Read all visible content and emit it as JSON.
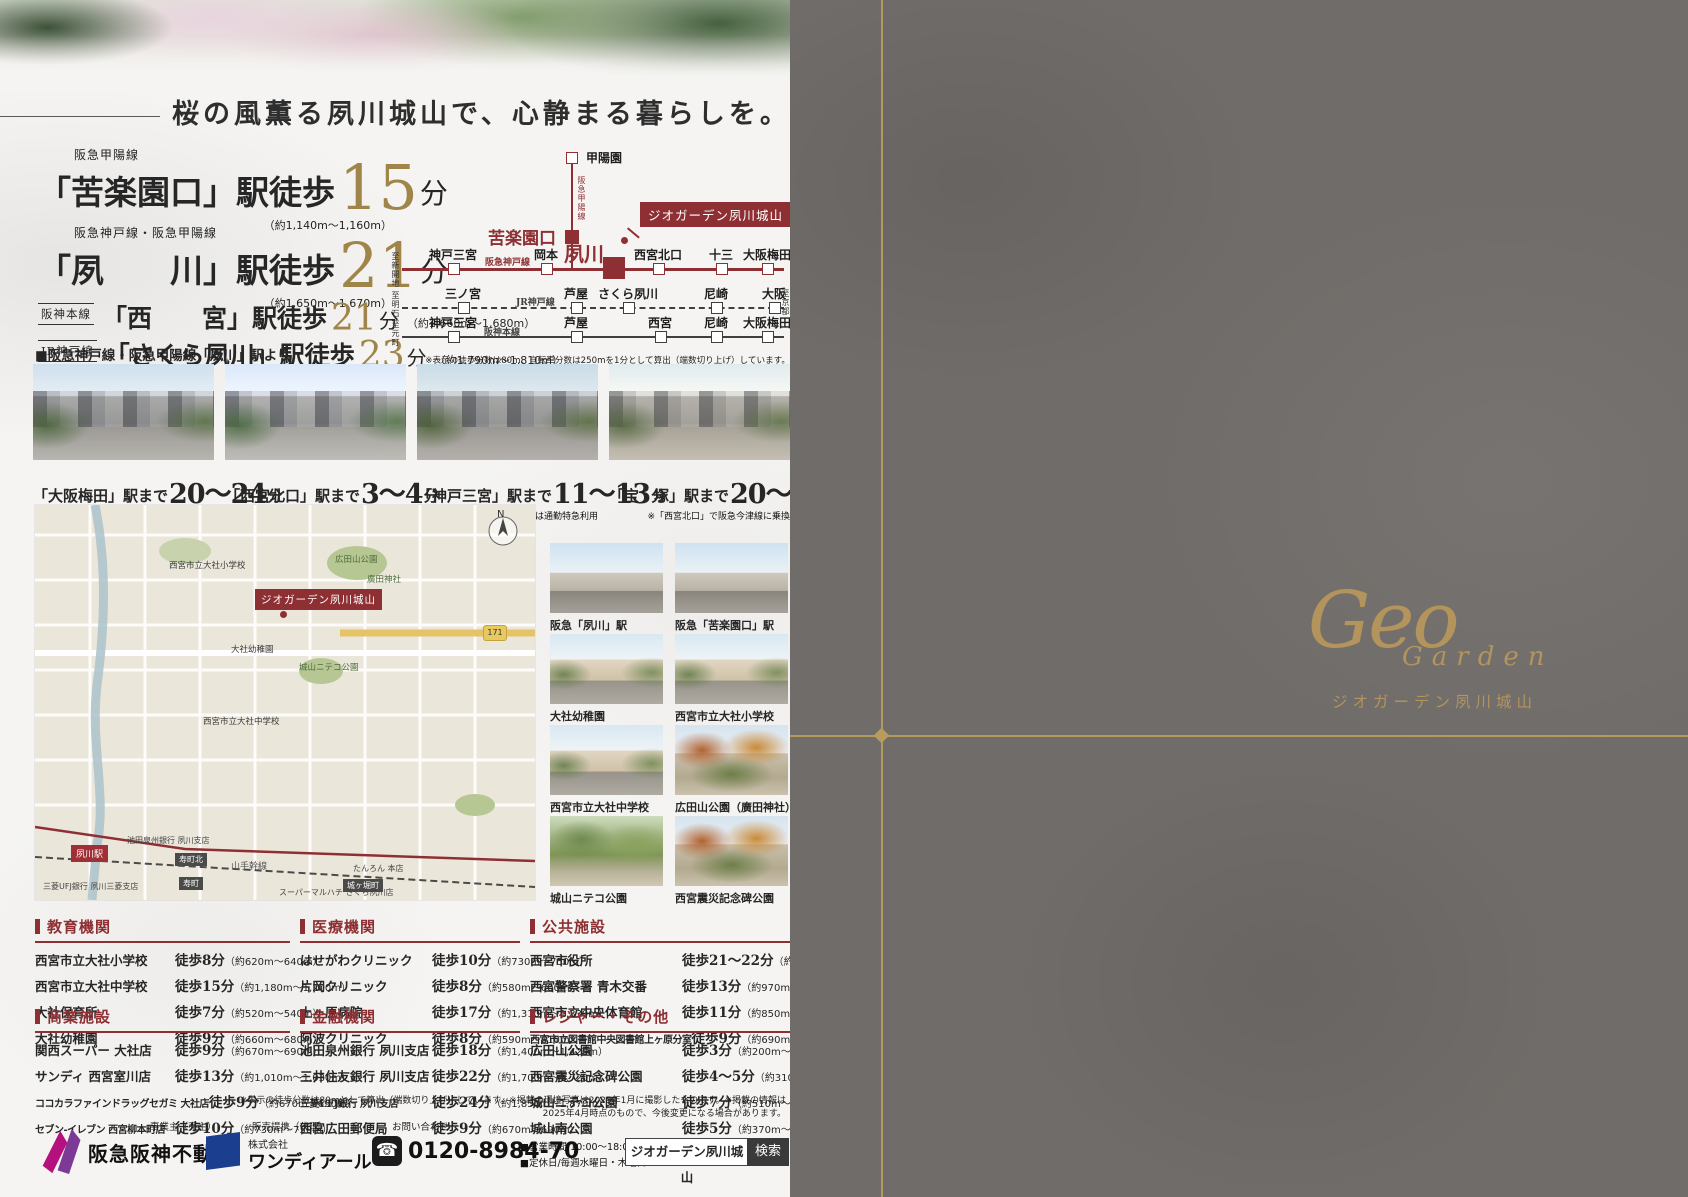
{
  "headline": {
    "text": "桜の風薫る夙川城山で、心静まる暮らしを。"
  },
  "access": {
    "stations": [
      {
        "line": "阪急甲陽線",
        "boxed": false,
        "station": "「苦楽園口」駅徒歩",
        "minutes": "15",
        "unit": "分",
        "distance": "（約1,140m〜1,160m）",
        "size": "l"
      },
      {
        "line": "阪急神戸線・阪急甲陽線",
        "boxed": false,
        "station": "「夙　　川」駅徒歩",
        "minutes": "21",
        "unit": "分",
        "distance": "（約1,650m〜1,670m）",
        "size": "l"
      },
      {
        "line": "阪神本線",
        "boxed": true,
        "station": "「西　　宮」駅徒歩",
        "minutes": "21",
        "unit": "分",
        "distance": "（約1,660m〜1,680m）",
        "size": "s"
      },
      {
        "line": "JR神戸線",
        "boxed": true,
        "station": "「さくら夙川」駅徒歩",
        "minutes": "23",
        "unit": "分",
        "distance": "（約1,790m〜1,810m）",
        "size": "s"
      }
    ]
  },
  "diagram": {
    "branch_line": "阪急甲陽線",
    "branch_top": "甲陽園",
    "branch_mid": "苦楽園口",
    "hub": "夙川",
    "property_flag": "ジオガーデン夙川城山",
    "lines": [
      {
        "name": "阪急神戸線",
        "left_to": "至新開地",
        "right_to": "",
        "stations": [
          "神戸三宮",
          "岡本",
          "西宮北口",
          "十三",
          "大阪梅田"
        ]
      },
      {
        "name": "JR神戸線",
        "left_to": "至明石",
        "right_to": "至京都",
        "stations": [
          "三ノ宮",
          "芦屋",
          "さくら夙川",
          "尼崎",
          "大阪"
        ]
      },
      {
        "name": "阪神本線",
        "left_to": "至元町",
        "right_to": "",
        "stations": [
          "神戸三宮",
          "芦屋",
          "西宮",
          "尼崎",
          "大阪梅田"
        ]
      }
    ],
    "note": "※表示の徒歩分数は80m、自転車分数は250mを1分として算出（端数切り上げ）しています。"
  },
  "station_photos": {
    "section_label": "■阪急神戸線・阪急甲陽線「夙川」駅より",
    "items": [
      {
        "pre": "「大阪梅田」駅まで",
        "time": "20〜24",
        "unit": "分",
        "note": "※特急または通勤特急利用"
      },
      {
        "pre": "「西宮北口」駅まで",
        "time": "3〜4",
        "unit": "分",
        "note": ""
      },
      {
        "pre": "「神戸三宮」駅まで",
        "time": "11〜13",
        "unit": "分",
        "note": "※特急または通勤特急利用"
      },
      {
        "pre": "「宝　塚」駅まで",
        "time": "20〜26",
        "unit": "分",
        "note": "※「西宮北口」で阪急今津線に乗換"
      }
    ]
  },
  "map": {
    "compass": "N",
    "route_badge": "171",
    "labels": [
      {
        "text": "ジオガーデン夙川城山",
        "type": "flag",
        "x": 220,
        "y": 84
      },
      {
        "text": "夙川駅",
        "type": "stationbox",
        "x": 36,
        "y": 340
      },
      {
        "text": "寿町北",
        "type": "darkbox",
        "x": 140,
        "y": 348
      },
      {
        "text": "寿町",
        "type": "darkbox",
        "x": 144,
        "y": 372
      },
      {
        "text": "城ヶ堀町",
        "type": "darkbox",
        "x": 308,
        "y": 374
      },
      {
        "text": "山手幹線",
        "type": "plain",
        "x": 196,
        "y": 354
      },
      {
        "text": "池田泉州銀行 夙川支店",
        "type": "tiny",
        "x": 92,
        "y": 330
      },
      {
        "text": "三菱UFJ銀行 夙川三菱支店",
        "type": "tiny",
        "x": 8,
        "y": 376
      },
      {
        "text": "スーパーマルハチ さくら夙川店",
        "type": "tiny",
        "x": 244,
        "y": 382
      },
      {
        "text": "たんろん 本店",
        "type": "tiny",
        "x": 318,
        "y": 358
      },
      {
        "text": "広田山公園",
        "type": "park",
        "x": 300,
        "y": 48
      },
      {
        "text": "廣田神社",
        "type": "park",
        "x": 332,
        "y": 68
      },
      {
        "text": "西宮市立大社小学校",
        "type": "tiny2",
        "x": 134,
        "y": 54
      },
      {
        "text": "大社幼稚園",
        "type": "tiny2",
        "x": 196,
        "y": 138
      },
      {
        "text": "西宮市立大社中学校",
        "type": "tiny2",
        "x": 168,
        "y": 210
      },
      {
        "text": "城山ニテコ公園",
        "type": "park",
        "x": 264,
        "y": 156
      }
    ]
  },
  "facility_photos": {
    "items": [
      {
        "caption": "阪急「夙川」駅",
        "style": "station"
      },
      {
        "caption": "阪急「苦楽園口」駅",
        "style": "station"
      },
      {
        "caption": "大社幼稚園",
        "style": "school"
      },
      {
        "caption": "西宮市立大社小学校",
        "style": "school"
      },
      {
        "caption": "西宮市立大社中学校",
        "style": "school"
      },
      {
        "caption": "広田山公園（廣田神社）",
        "style": "autumn"
      },
      {
        "caption": "城山ニテコ公園",
        "style": "park"
      },
      {
        "caption": "西宮震災記念碑公園",
        "style": "autumn"
      }
    ]
  },
  "facilities": [
    {
      "title": "教育機関",
      "rows": [
        {
          "name": "西宮市立大社小学校",
          "time": "徒歩8分",
          "dist": "（約620m〜640m）"
        },
        {
          "name": "西宮市立大社中学校",
          "time": "徒歩15分",
          "dist": "（約1,180m〜1,200m）"
        },
        {
          "name": "大社保育所",
          "time": "徒歩7分",
          "dist": "（約520m〜540m）"
        },
        {
          "name": "大社幼稚園",
          "time": "徒歩9分",
          "dist": "（約660m〜680m）"
        }
      ]
    },
    {
      "title": "商業施設",
      "rows": [
        {
          "name": "関西スーパー 大社店",
          "time": "徒歩9分",
          "dist": "（約670m〜690m）"
        },
        {
          "name": "サンディ 西宮室川店",
          "time": "徒歩13分",
          "dist": "（約1,010m〜1,030m）"
        },
        {
          "name": "ココカラファインドラッグセガミ 大社店",
          "time": "徒歩9分",
          "dist": "（約670m〜690m）"
        },
        {
          "name": "セブン-イレブン 西宮柳本町店",
          "time": "徒歩10分",
          "dist": "（約730m〜750m）"
        }
      ]
    },
    {
      "title": "医療機関",
      "rows": [
        {
          "name": "はせがわクリニック",
          "time": "徒歩10分",
          "dist": "（約730m〜750m）"
        },
        {
          "name": "片岡クリニック",
          "time": "徒歩8分",
          "dist": "（約580m〜600m）"
        },
        {
          "name": "上ヶ原病院",
          "time": "徒歩17分",
          "dist": "（約1,310m〜1,330m）"
        },
        {
          "name": "阿波クリニック",
          "time": "徒歩8分",
          "dist": "（約590m〜610m）"
        }
      ]
    },
    {
      "title": "金融機関",
      "rows": [
        {
          "name": "池田泉州銀行 夙川支店",
          "time": "徒歩18分",
          "dist": "（約1,400m〜1,420m）"
        },
        {
          "name": "三井住友銀行 夙川支店",
          "time": "徒歩22分",
          "dist": "（約1,700m〜1,720m）"
        },
        {
          "name": "三菱UFJ銀行 夙川支店",
          "time": "徒歩24分",
          "dist": "（約1,850m〜1,870m）"
        },
        {
          "name": "西宮広田郵便局",
          "time": "徒歩9分",
          "dist": "（約670m〜690m）"
        }
      ]
    },
    {
      "title": "公共施設",
      "rows": [
        {
          "name": "西宮市役所",
          "time": "徒歩21〜22分",
          "dist": "（約1,670m〜1,690m）"
        },
        {
          "name": "西宮警察署 青木交番",
          "time": "徒歩13分",
          "dist": "（約970m〜990m）"
        },
        {
          "name": "西宮市立中央体育館",
          "time": "徒歩11分",
          "dist": "（約850m〜870m）"
        },
        {
          "name": "西宮市立図書館中央図書館上ヶ原分室",
          "time": "徒歩9分",
          "dist": "（約690m〜710m）"
        }
      ]
    },
    {
      "title": "レジャー・その他",
      "rows": [
        {
          "name": "広田山公園",
          "time": "徒歩3分",
          "dist": "（約200m〜220m）"
        },
        {
          "name": "西宮震災記念碑公園",
          "time": "徒歩4〜5分",
          "dist": "（約310m〜330m）"
        },
        {
          "name": "城山ニテコ公園",
          "time": "徒歩7分",
          "dist": "（約510m〜530m）"
        },
        {
          "name": "城山南公園",
          "time": "徒歩5分",
          "dist": "（約370m〜390m）"
        }
      ]
    }
  ],
  "footnote": "※表示の徒歩分数は80mとして算出（端数切り上げ）しています。※掲載の環境写真は2025年1月に撮影したものです。※掲載の情報は2025年4月時点のもので、今後変更になる場合があります。",
  "footer": {
    "developer_label": "事業主（売主）",
    "developer": "阪急阪神不動産",
    "agency_label": "販売提携（代理）",
    "agency_prefix": "株式会社",
    "agency": "ワンディアール",
    "contact_label": "お問い合わせ",
    "phone_icon": "☎",
    "phone": "0120-8984-70",
    "hours": "■営業時間/10:00〜18:00",
    "holiday": "■定休日/毎週水曜日・木曜日",
    "search_text": "ジオガーデン夙川城山",
    "search_button": "検索"
  },
  "right_panel": {
    "logo_en_1": "Geo",
    "logo_en_2": "Garden",
    "logo_jp": "ジオガーデン夙川城山"
  },
  "colors": {
    "accent_red": "#8e3033",
    "gold": "#a0854a",
    "panel_gray": "#706c69",
    "gold_line": "#b79c5e"
  }
}
